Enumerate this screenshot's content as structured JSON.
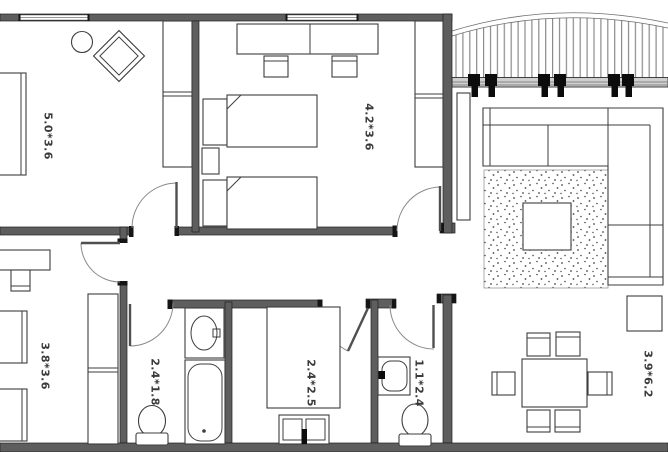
{
  "plan": {
    "type": "apartment-floor-plan",
    "rooms": [
      {
        "id": "bedroom-1",
        "label": "5.0*3.6"
      },
      {
        "id": "bedroom-2",
        "label": "4.2*3.6"
      },
      {
        "id": "bedroom-3",
        "label": "3.8*3.6"
      },
      {
        "id": "bathroom",
        "label": "2.4*1.8"
      },
      {
        "id": "bedroom-4",
        "label": "2.4*2.5"
      },
      {
        "id": "wc",
        "label": "1.1*2.4"
      },
      {
        "id": "living-room",
        "label": "3.9*6.2"
      }
    ],
    "colors": {
      "wall": "#5e5e5e",
      "wall_cap": "#151515",
      "furniture_line": "#3d3d3d",
      "door_arc": "#8a8a8a",
      "label_text": "#3a3a3a",
      "background": "#ffffff"
    }
  }
}
